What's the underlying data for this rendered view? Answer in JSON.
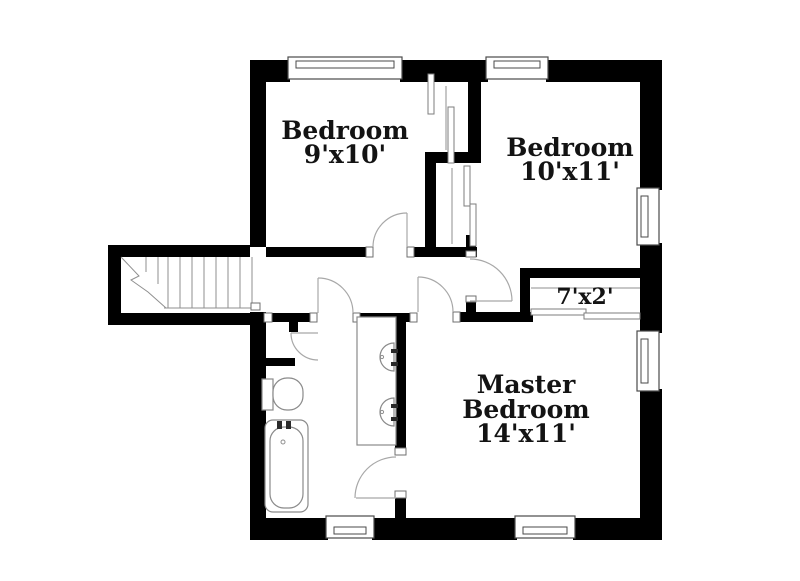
{
  "plan": {
    "type": "floor-plan",
    "rooms": {
      "bedroom1": {
        "label": "Bedroom",
        "size": "9'x10'"
      },
      "bedroom2": {
        "label": "Bedroom",
        "size": "10'x11'"
      },
      "closet": {
        "size": "7'x2'"
      },
      "master": {
        "label_line1": "Master",
        "label_line2": "Bedroom",
        "size": "14'x11'"
      }
    },
    "elements": [
      "staircase",
      "bathtub",
      "toilet",
      "double-vanity-sinks",
      "sliding-closet-doors",
      "hinged-doors",
      "windows"
    ],
    "colors": {
      "walls": "#000000",
      "background": "#ffffff",
      "thin_lines": "#8f8f8f",
      "door_arcs": "#a8a8a8",
      "text": "#131313"
    }
  }
}
